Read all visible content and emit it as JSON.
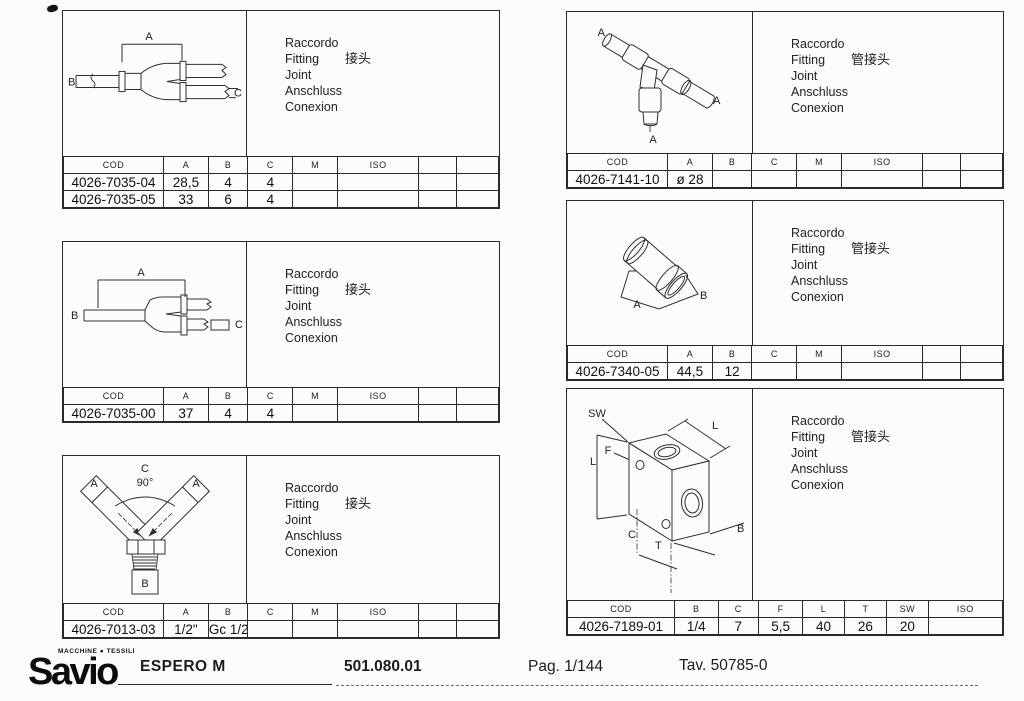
{
  "page": {
    "background": "#fcfcfa",
    "line_color": "#2a2a2a"
  },
  "panels": [
    {
      "id": "p1",
      "caption": {
        "it": "Raccordo",
        "en": "Fitting",
        "zh": "接头",
        "fr": "Joint",
        "de": "Anschluss",
        "es": "Conexion"
      },
      "drawing": {
        "kind": "y-splitter-fitting-side-view",
        "labels": [
          "A",
          "B",
          "C"
        ]
      },
      "table": {
        "headers": [
          "COD",
          "A",
          "B",
          "C",
          "M",
          "ISO",
          "",
          ""
        ],
        "rows": [
          [
            "4026-7035-04",
            "28,5",
            "4",
            "4",
            "",
            "",
            "",
            ""
          ],
          [
            "4026-7035-05",
            "33",
            "6",
            "4",
            "",
            "",
            "",
            ""
          ]
        ]
      }
    },
    {
      "id": "p2",
      "caption": {
        "it": "Raccordo",
        "en": "Fitting",
        "zh": "接头",
        "fr": "Joint",
        "de": "Anschluss",
        "es": "Conexion"
      },
      "drawing": {
        "kind": "y-splitter-fitting-side-view",
        "labels": [
          "A",
          "B",
          "C"
        ]
      },
      "table": {
        "headers": [
          "COD",
          "A",
          "B",
          "C",
          "M",
          "ISO",
          "",
          ""
        ],
        "rows": [
          [
            "4026-7035-00",
            "37",
            "4",
            "4",
            "",
            "",
            "",
            ""
          ]
        ]
      }
    },
    {
      "id": "p3",
      "caption": {
        "it": "Raccordo",
        "en": "Fitting",
        "zh": "接头",
        "fr": "Joint",
        "de": "Anschluss",
        "es": "Conexion"
      },
      "drawing": {
        "kind": "y-fitting-front-view-threaded",
        "labels": [
          "C",
          "90°",
          "A",
          "A",
          "B"
        ]
      },
      "table": {
        "headers": [
          "COD",
          "A",
          "B",
          "C",
          "M",
          "ISO",
          "",
          ""
        ],
        "rows": [
          [
            "4026-7013-03",
            "1/2\"",
            "Gc 1/2\"",
            "",
            "",
            "",
            "",
            ""
          ]
        ]
      }
    },
    {
      "id": "p4",
      "caption": {
        "it": "Raccordo",
        "en": "Fitting",
        "zh": "管接头",
        "fr": "Joint",
        "de": "Anschluss",
        "es": "Conexion"
      },
      "drawing": {
        "kind": "tee-tube-fitting",
        "labels": [
          "A",
          "A",
          "A"
        ]
      },
      "table": {
        "headers": [
          "COD",
          "A",
          "B",
          "C",
          "M",
          "ISO",
          "",
          ""
        ],
        "rows": [
          [
            "4026-7141-10",
            "ø 28",
            "",
            "",
            "",
            "",
            "",
            ""
          ]
        ]
      }
    },
    {
      "id": "p5",
      "caption": {
        "it": "Raccordo",
        "en": "Fitting",
        "zh": "管接头",
        "fr": "Joint",
        "de": "Anschluss",
        "es": "Conexion"
      },
      "drawing": {
        "kind": "sleeve-tube-fitting",
        "labels": [
          "A",
          "B"
        ]
      },
      "table": {
        "headers": [
          "COD",
          "A",
          "B",
          "C",
          "M",
          "ISO",
          "",
          ""
        ],
        "rows": [
          [
            "4026-7340-05",
            "44,5",
            "12",
            "",
            "",
            "",
            "",
            ""
          ]
        ]
      }
    },
    {
      "id": "p6",
      "caption": {
        "it": "Raccordo",
        "en": "Fitting",
        "zh": "管接头",
        "fr": "Joint",
        "de": "Anschluss",
        "es": "Conexion"
      },
      "drawing": {
        "kind": "block-manifold-fitting",
        "labels": [
          "SW",
          "L",
          "F",
          "L",
          "C",
          "T",
          "B"
        ]
      },
      "table": {
        "headers": [
          "COD",
          "B",
          "C",
          "F",
          "L",
          "T",
          "SW",
          "ISO"
        ],
        "rows": [
          [
            "4026-7189-01",
            "1/4",
            "7",
            "5,5",
            "40",
            "26",
            "20",
            ""
          ]
        ]
      }
    }
  ],
  "footer": {
    "brand": "Savio",
    "brand_tagline": "MACCHINE ● TESSILI",
    "machine": "ESPERO M",
    "code": "501.080.01",
    "page_label": "Pag. 1/144",
    "table_label": "Tav. 50785-0"
  }
}
